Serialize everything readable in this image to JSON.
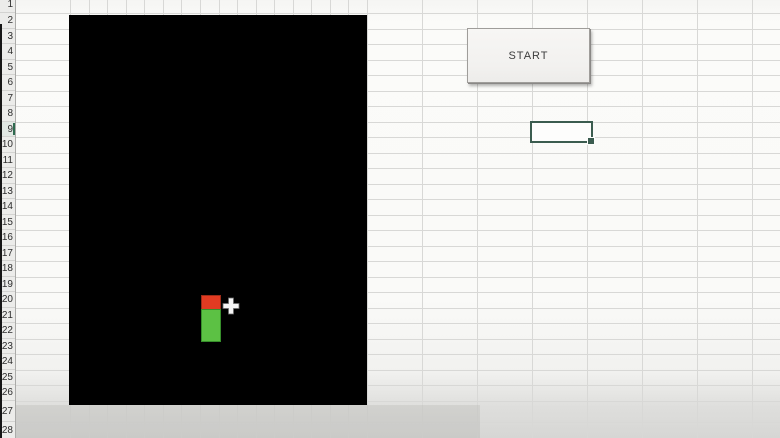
{
  "window": {
    "app": "spreadsheet-snake-game"
  },
  "spreadsheet": {
    "row_headers": [
      "1",
      "2",
      "3",
      "4",
      "5",
      "6",
      "7",
      "8",
      "9",
      "10",
      "11",
      "12",
      "13",
      "14",
      "15",
      "16",
      "17",
      "18",
      "19",
      "20",
      "21",
      "22",
      "23",
      "24",
      "25",
      "26",
      "27",
      "28"
    ],
    "selected_row": "9"
  },
  "start_button": {
    "label": "START"
  },
  "game": {
    "board_icon": "game-board",
    "snake_head_icon": "snake-head-block",
    "snake_body_icon": "snake-body-block",
    "cursor_icon": "cell-cursor-plus"
  },
  "colors": {
    "board": "#000000",
    "snake_head": "#e23b22",
    "snake_body": "#5cc144",
    "selection_border": "#3b5c4f",
    "grid_line": "#d8d8d6",
    "header_bg": "#ececea",
    "button_bg": "#f2f1ef"
  }
}
